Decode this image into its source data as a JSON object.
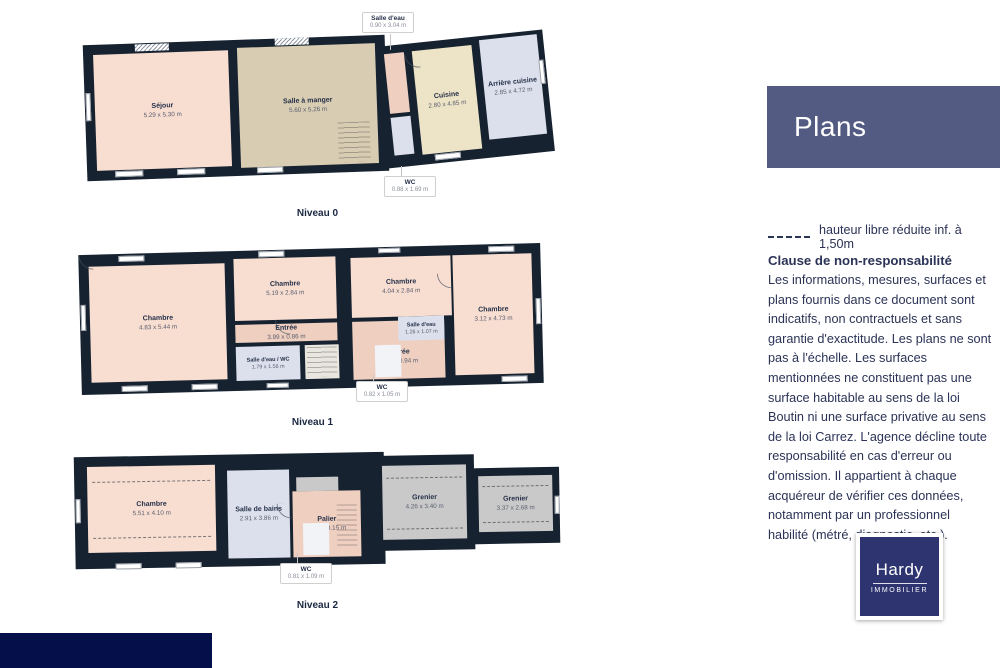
{
  "floors": [
    {
      "label": "Niveau 0",
      "rooms": {
        "sejour": {
          "name": "Séjour",
          "dims": "5.29 x 5.30 m"
        },
        "salle_a_manger": {
          "name": "Salle à manger",
          "dims": "5.60 x 5.26 m"
        },
        "cuisine": {
          "name": "Cuisine",
          "dims": "2.80 x 4.85 m"
        },
        "arriere_cuisine": {
          "name": "Arrière cuisine",
          "dims": "2.85 x 4.72 m"
        }
      },
      "callouts": {
        "salle_deau": {
          "name": "Salle d'eau",
          "dims": "0.90 x 3.04 m"
        },
        "wc": {
          "name": "WC",
          "dims": "0.88 x 1.69 m"
        }
      }
    },
    {
      "label": "Niveau 1",
      "rooms": {
        "chambre1": {
          "name": "Chambre",
          "dims": "4.83 x 5.44 m"
        },
        "chambre2": {
          "name": "Chambre",
          "dims": "5.19 x 2.84 m"
        },
        "entree1": {
          "name": "Entrée",
          "dims": "3.99 x 0.86 m"
        },
        "salle_deau_wc": {
          "name": "Salle d'eau / WC",
          "dims": "1.79 x 1.56 m"
        },
        "chambre3": {
          "name": "Chambre",
          "dims": "4.04 x 2.84 m"
        },
        "salle_deau": {
          "name": "Salle d'eau",
          "dims": "1.26 x 1.07 m"
        },
        "entree2": {
          "name": "Entrée",
          "dims": "2.59 x 0.94 m"
        },
        "chambre4": {
          "name": "Chambre",
          "dims": "3.12 x 4.73 m"
        }
      },
      "callouts": {
        "wc": {
          "name": "WC",
          "dims": "0.82 x 1.05 m"
        }
      }
    },
    {
      "label": "Niveau 2",
      "rooms": {
        "chambre": {
          "name": "Chambre",
          "dims": "5.51 x 4.10 m"
        },
        "salle_de_bains": {
          "name": "Salle de bains",
          "dims": "2.91 x 3.86 m"
        },
        "palier": {
          "name": "Palier",
          "dims": "3.02 x 3.15 m"
        },
        "grenier1": {
          "name": "Grenier",
          "dims": "4.26 x 3.40 m"
        },
        "grenier2": {
          "name": "Grenier",
          "dims": "3.37 x 2.68 m"
        }
      },
      "callouts": {
        "wc": {
          "name": "WC",
          "dims": "0.81 x 1.09 m"
        }
      }
    }
  ],
  "panel": {
    "title": "Plans",
    "legend_text": "hauteur libre réduite inf. à 1,50m",
    "disclaimer_title": "Clause de non-responsabilité",
    "disclaimer_body": "Les informations, mesures, surfaces et plans fournis dans ce document sont indicatifs, non contractuels et sans garantie d'exactitude. Les plans ne sont pas à l'échelle. Les surfaces mentionnées ne constituent pas une surface habitable au sens de la loi Boutin ni une surface privative au sens de la loi Carrez. L'agence décline toute responsabilité en cas d'erreur ou d'omission. Il appartient à chaque acquéreur de vérifier ces données, notamment par un professionnel habilité (métré, diagnostic, etc.)."
  },
  "logo": {
    "brand": "Hardy",
    "tagline": "IMMOBILIER"
  },
  "colors": {
    "wall": "#172230",
    "room_pink": "#f8ddd1",
    "room_tan": "#d8ccb2",
    "room_cream": "#ede3c6",
    "room_blue": "#dce0ec",
    "room_salmon": "#eecfc0",
    "room_gray": "#c9c9c9",
    "room_light": "#e9e6df",
    "room_white": "#f2f3f6",
    "panel_header": "#545b82",
    "logo_navy": "#2e3470",
    "footer_navy": "#05104a",
    "text_navy": "#2b3356",
    "label_navy": "#1a2742"
  }
}
